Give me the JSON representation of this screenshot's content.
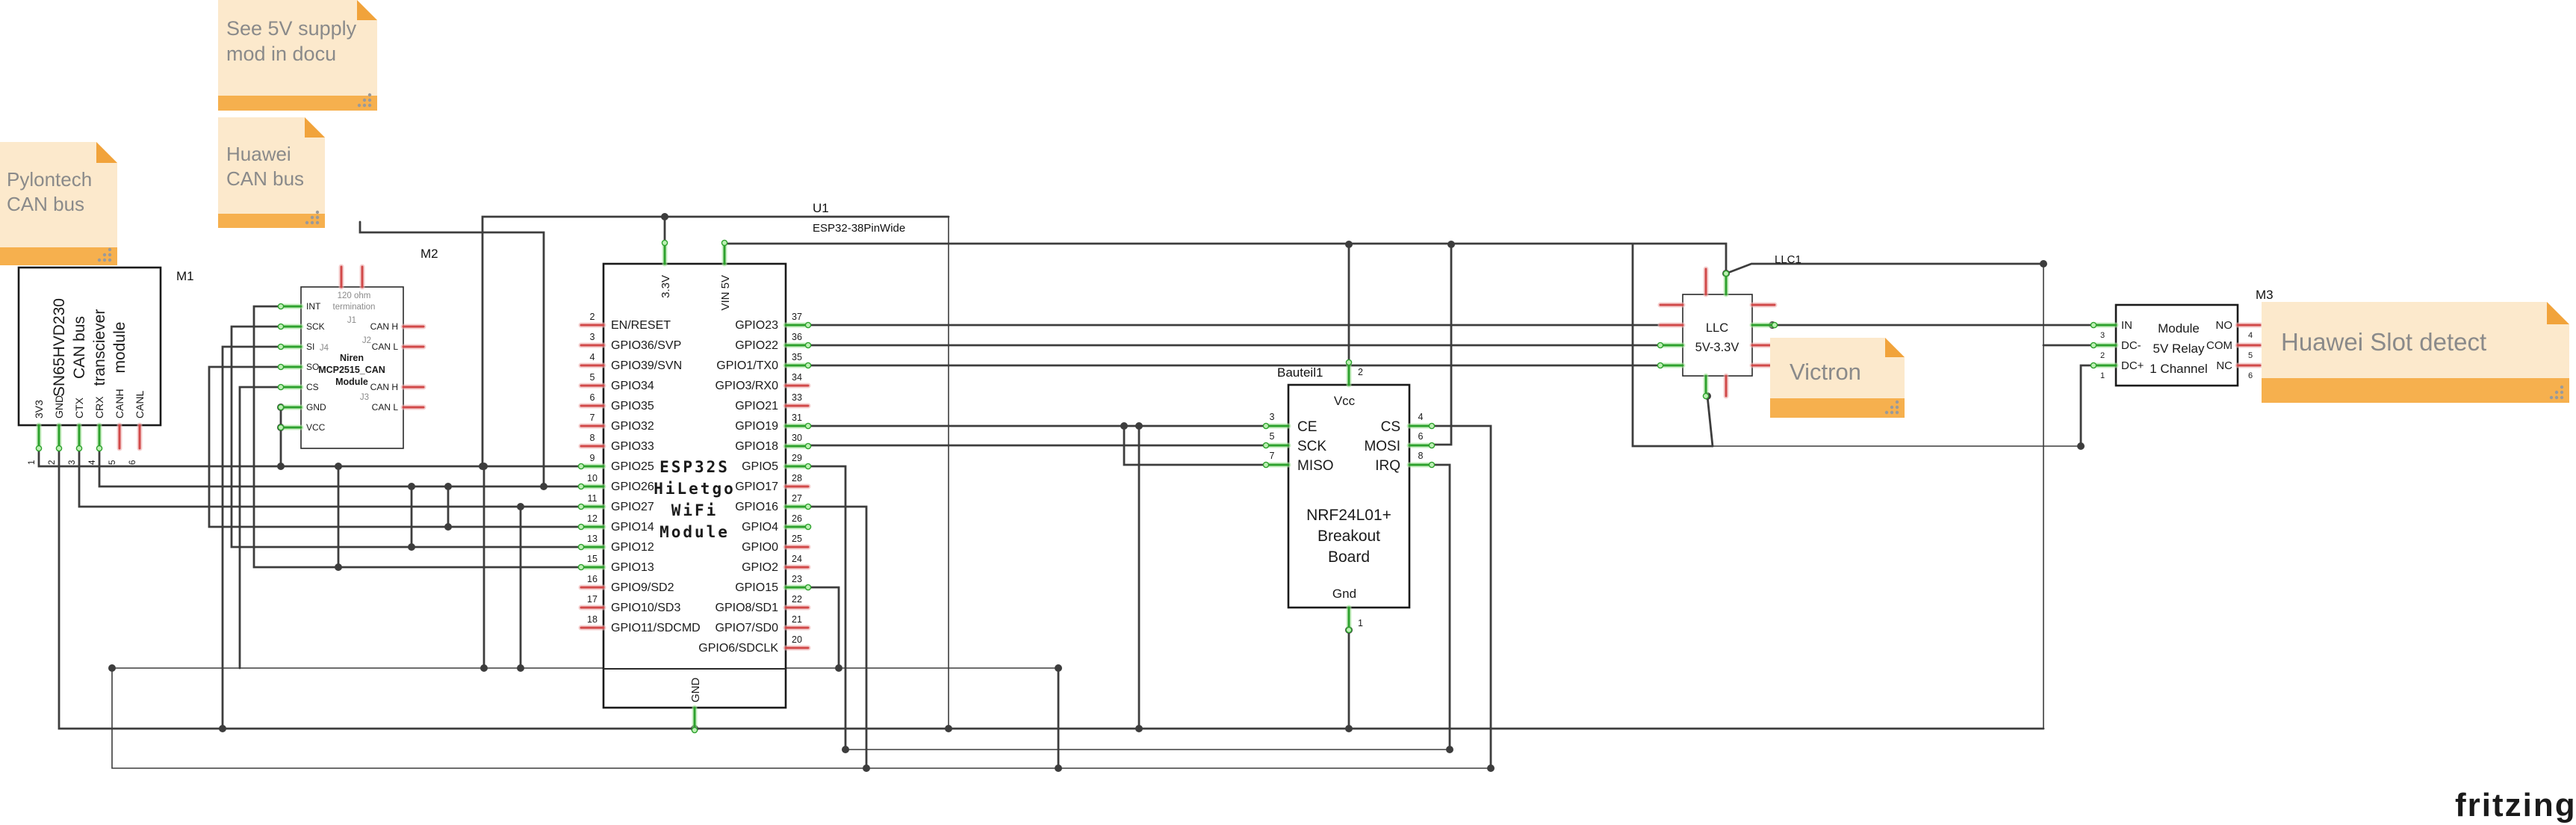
{
  "colors": {
    "wire": "#3d3d3d",
    "pin_green": "#2da12d",
    "pin_green_glow": "#a9e6a0",
    "pin_red": "#d14949",
    "pin_red_glow": "#f0b3b3",
    "note_bg": "#fce9cc",
    "note_bar": "#f6b04e",
    "note_fold": "#f1a33b",
    "note_text": "#8a8a8a"
  },
  "watermark": "fritzing",
  "notes": {
    "see5v": {
      "lines": [
        "See 5V supply",
        "mod in docu"
      ]
    },
    "pylontech": {
      "lines": [
        "Pylontech",
        "CAN bus"
      ]
    },
    "huawei_can": {
      "lines": [
        "Huawei",
        "CAN bus"
      ]
    },
    "victron": {
      "lines": [
        "Victron"
      ]
    },
    "huawei_slot": {
      "lines": [
        "Huawei Slot detect"
      ]
    }
  },
  "components": {
    "m1": {
      "ref": "M1",
      "lines": [
        "SN65HVD230",
        "CAN bus",
        "transciever",
        "module"
      ],
      "pins": [
        {
          "n": "1",
          "label": "3V3",
          "c": true
        },
        {
          "n": "2",
          "label": "GND",
          "c": true
        },
        {
          "n": "3",
          "label": "CTX",
          "c": true
        },
        {
          "n": "4",
          "label": "CRX",
          "c": true
        },
        {
          "n": "5",
          "label": "CANH",
          "c": false
        },
        {
          "n": "6",
          "label": "CANL",
          "c": false
        }
      ]
    },
    "m2": {
      "ref": "M2",
      "inner": {
        "res1": "120 ohm",
        "res2": "termination",
        "j1": "J1",
        "j2": "J2",
        "j4": "J4",
        "name1": "Niren",
        "name2": "MCP2515_CAN",
        "name3": "Module",
        "j3": "J3"
      },
      "left": [
        {
          "label": "INT",
          "c": true
        },
        {
          "label": "SCK",
          "c": true
        },
        {
          "label": "SI",
          "c": true
        },
        {
          "label": "SO",
          "c": true
        },
        {
          "label": "CS",
          "c": true
        },
        {
          "label": "GND",
          "c": true
        },
        {
          "label": "VCC",
          "c": true
        }
      ],
      "right": [
        {
          "label": "CAN H",
          "c": false
        },
        {
          "label": "CAN L",
          "c": false
        },
        {
          "label": "CAN H",
          "c": false
        },
        {
          "label": "CAN L",
          "c": false
        }
      ],
      "top": [
        {
          "c": false
        },
        {
          "c": false
        }
      ]
    },
    "u1": {
      "ref": "U1",
      "type": "ESP32-38PinWide",
      "title": [
        "ESP32S",
        "HiLetgo",
        "WiFi",
        "Module"
      ],
      "top": [
        {
          "label": "3.3V",
          "c": true
        },
        {
          "label": "VIN 5V",
          "c": true
        }
      ],
      "bottom": [
        {
          "label": "GND",
          "c": true
        }
      ],
      "left": [
        {
          "n": "2",
          "label": "EN/RESET",
          "c": false
        },
        {
          "n": "3",
          "label": "GPIO36/SVP",
          "c": false
        },
        {
          "n": "4",
          "label": "GPIO39/SVN",
          "c": false
        },
        {
          "n": "5",
          "label": "GPIO34",
          "c": false
        },
        {
          "n": "6",
          "label": "GPIO35",
          "c": false
        },
        {
          "n": "7",
          "label": "GPIO32",
          "c": false
        },
        {
          "n": "8",
          "label": "GPIO33",
          "c": false
        },
        {
          "n": "9",
          "label": "GPIO25",
          "c": true
        },
        {
          "n": "10",
          "label": "GPIO26",
          "c": true
        },
        {
          "n": "11",
          "label": "GPIO27",
          "c": true
        },
        {
          "n": "12",
          "label": "GPIO14",
          "c": true
        },
        {
          "n": "13",
          "label": "GPIO12",
          "c": true
        },
        {
          "n": "15",
          "label": "GPIO13",
          "c": true
        },
        {
          "n": "16",
          "label": "GPIO9/SD2",
          "c": false
        },
        {
          "n": "17",
          "label": "GPIO10/SD3",
          "c": false
        },
        {
          "n": "18",
          "label": "GPIO11/SDCMD",
          "c": false
        }
      ],
      "right": [
        {
          "n": "37",
          "label": "GPIO23",
          "c": true
        },
        {
          "n": "36",
          "label": "GPIO22",
          "c": true
        },
        {
          "n": "35",
          "label": "GPIO1/TX0",
          "c": true
        },
        {
          "n": "34",
          "label": "GPIO3/RX0",
          "c": false
        },
        {
          "n": "33",
          "label": "GPIO21",
          "c": false
        },
        {
          "n": "31",
          "label": "GPIO19",
          "c": true
        },
        {
          "n": "30",
          "label": "GPIO18",
          "c": true
        },
        {
          "n": "29",
          "label": "GPIO5",
          "c": true
        },
        {
          "n": "28",
          "label": "GPIO17",
          "c": false
        },
        {
          "n": "27",
          "label": "GPIO16",
          "c": true
        },
        {
          "n": "26",
          "label": "GPIO4",
          "c": true
        },
        {
          "n": "25",
          "label": "GPIO0",
          "c": false
        },
        {
          "n": "24",
          "label": "GPIO2",
          "c": false
        },
        {
          "n": "23",
          "label": "GPIO15",
          "c": true
        },
        {
          "n": "22",
          "label": "GPIO8/SD1",
          "c": false
        },
        {
          "n": "21",
          "label": "GPIO7/SD0",
          "c": false
        },
        {
          "n": "20",
          "label": "GPIO6/SDCLK",
          "c": false
        }
      ]
    },
    "nrf": {
      "ref": "Bauteil1",
      "title": [
        "NRF24L01+",
        "Breakout",
        "Board"
      ],
      "top_label": "Vcc",
      "bottom_label": "Gnd",
      "top": [
        {
          "n": "2",
          "c": true
        }
      ],
      "bottom": [
        {
          "n": "1",
          "c": true
        }
      ],
      "left": [
        {
          "n": "3",
          "label": "CE",
          "c": true
        },
        {
          "n": "5",
          "label": "SCK",
          "c": true
        },
        {
          "n": "7",
          "label": "MISO",
          "c": true
        }
      ],
      "right": [
        {
          "n": "4",
          "label": "CS",
          "c": true
        },
        {
          "n": "6",
          "label": "MOSI",
          "c": true
        },
        {
          "n": "8",
          "label": "IRQ",
          "c": true
        }
      ]
    },
    "llc": {
      "ref": "LLC1",
      "lines": [
        "LLC",
        "5V-3.3V"
      ]
    },
    "m3": {
      "ref": "M3",
      "lines": [
        "Module",
        "5V Relay",
        "1 Channel"
      ],
      "left": [
        {
          "n": "3",
          "label": "IN",
          "c": true
        },
        {
          "n": "2",
          "label": "DC-",
          "c": true
        },
        {
          "n": "1",
          "label": "DC+",
          "c": true
        }
      ],
      "right": [
        {
          "n": "4",
          "label": "NO",
          "c": false
        },
        {
          "n": "5",
          "label": "COM",
          "c": false
        },
        {
          "n": "6",
          "label": "NC",
          "c": false
        }
      ]
    }
  }
}
